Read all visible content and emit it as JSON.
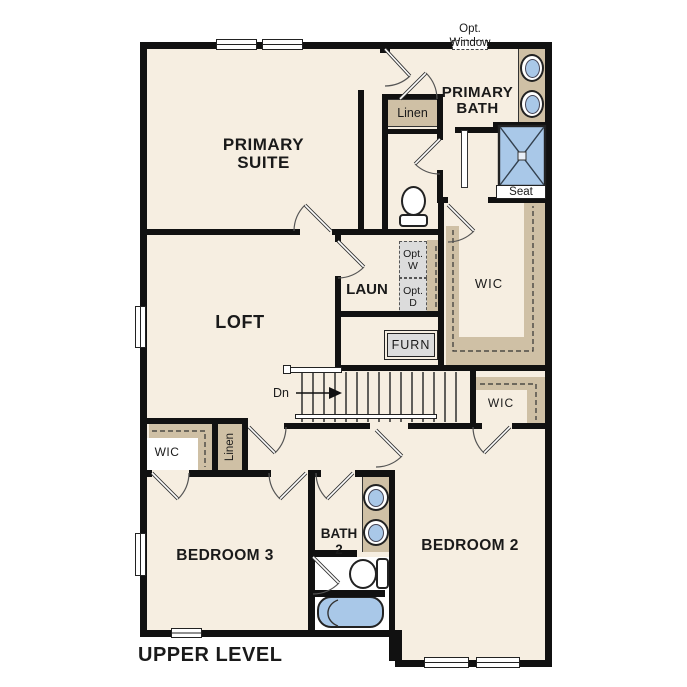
{
  "palette": {
    "floor": "#f6eee1",
    "wall": "#111111",
    "millwork": "#cfc0a5",
    "fixture_blue": "#a9c8e8",
    "appliance_gray": "#dcdcdc"
  },
  "plan": {
    "title": "UPPER LEVEL",
    "annotations": {
      "opt_window_line1": "Opt.",
      "opt_window_line2": "Window",
      "stair_direction": "Dn",
      "shower_seat": "Seat"
    },
    "rooms": {
      "primary_suite": {
        "line1": "PRIMARY",
        "line2": "SUITE"
      },
      "primary_bath": {
        "line1": "PRIMARY",
        "line2": "BATH"
      },
      "loft": "LOFT",
      "laundry": "LAUN",
      "primary_wic": "WIC",
      "bedroom2_wic": "WIC",
      "bedroom3_wic": "WIC",
      "linen_bath": "Linen",
      "linen_hall": "Linen",
      "furnace": "FURN",
      "bath2": {
        "line1": "BATH",
        "line2": "2"
      },
      "bedroom2": "BEDROOM 2",
      "bedroom3": "BEDROOM 3"
    },
    "appliances": {
      "washer_line1": "Opt.",
      "washer_line2": "W",
      "dryer_line1": "Opt.",
      "dryer_line2": "D"
    }
  }
}
